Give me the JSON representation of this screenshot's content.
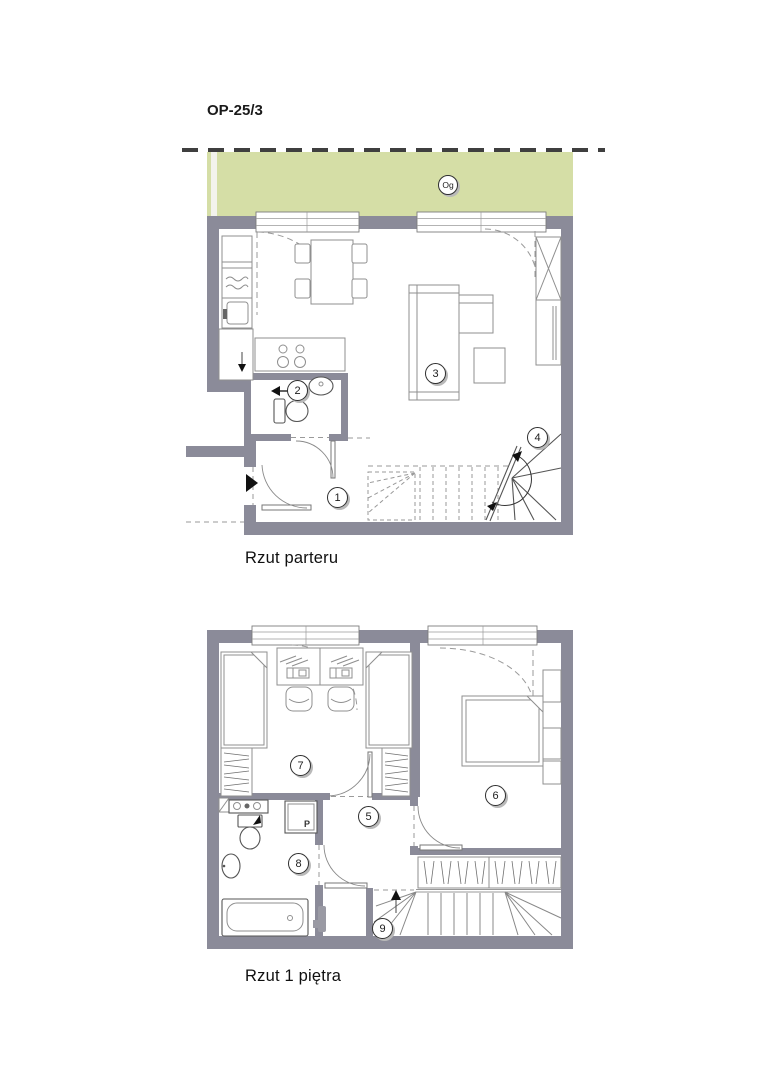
{
  "title": "OP-25/3",
  "colors": {
    "wall": "#8b8b99",
    "garden": "#d5dea6",
    "boundary": "#3f3f3f",
    "furniture_line": "#8f8f8f",
    "fixture_line": "#555555"
  },
  "plans": {
    "ground": {
      "caption": "Rzut parteru",
      "garden_label": "Og",
      "rooms": [
        {
          "number": "1"
        },
        {
          "number": "2"
        },
        {
          "number": "3"
        },
        {
          "number": "4"
        }
      ]
    },
    "first": {
      "caption": "Rzut 1 piętra",
      "shower_label": "P",
      "rooms": [
        {
          "number": "5"
        },
        {
          "number": "6"
        },
        {
          "number": "7"
        },
        {
          "number": "8"
        },
        {
          "number": "9"
        }
      ]
    }
  }
}
